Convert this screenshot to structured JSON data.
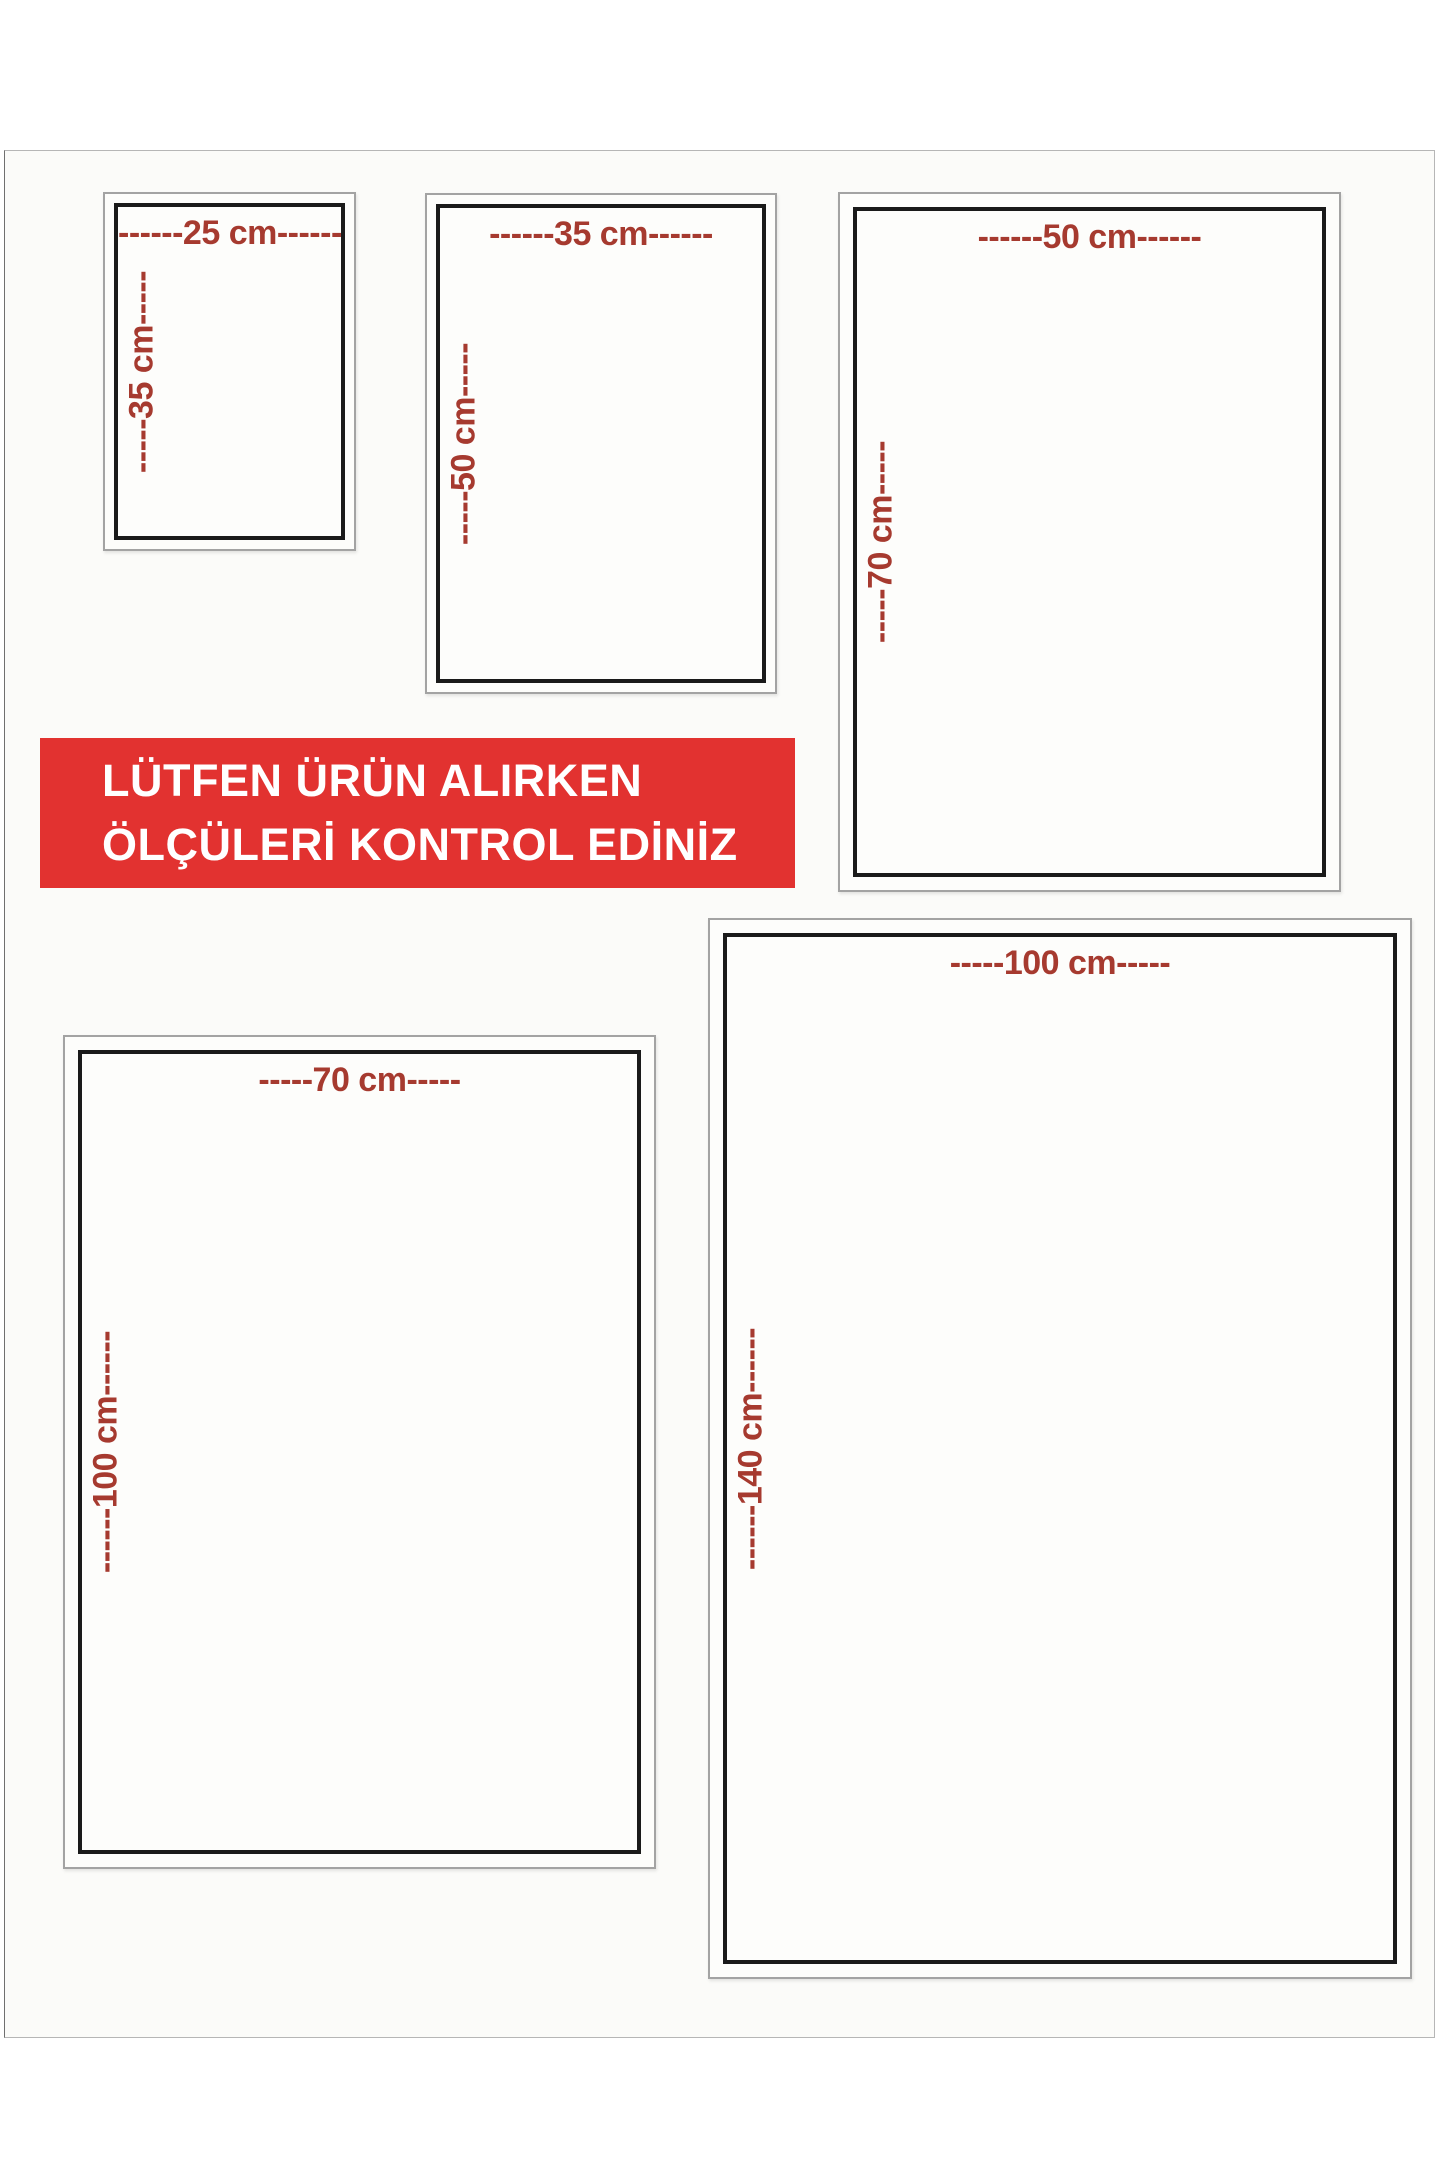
{
  "banner": {
    "line1": "LÜTFEN ÜRÜN ALIRKEN",
    "line2": "ÖLÇÜLERİ KONTROL EDİNİZ"
  },
  "colors": {
    "banner_red": "#e23230",
    "label_red": "#a63a2f",
    "frame_black": "#1a1a1a",
    "frame_gray": "#a3a3a3",
    "page_bg": "#fbfbf9"
  },
  "sizes": [
    {
      "name": "25x35 cm",
      "width_label": "------25 cm------",
      "height_label": "-----35 cm-----"
    },
    {
      "name": "35x50 cm",
      "width_label": "------35 cm------",
      "height_label": "-----50 cm-----"
    },
    {
      "name": "50x70 cm",
      "width_label": "------50 cm------",
      "height_label": "-----70 cm-----"
    },
    {
      "name": "70x100 cm",
      "width_label": "-----70 cm-----",
      "height_label": "------100 cm------"
    },
    {
      "name": "100x140 cm",
      "width_label": "-----100 cm-----",
      "height_label": "------140 cm------"
    }
  ]
}
